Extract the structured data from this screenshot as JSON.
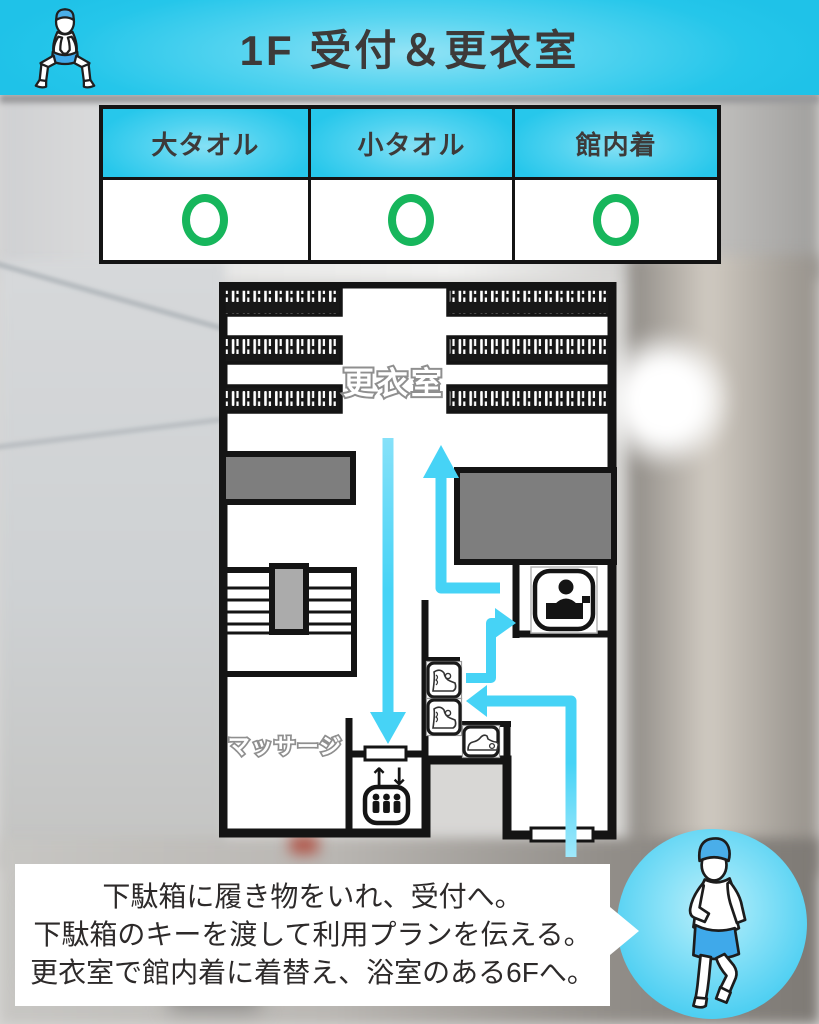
{
  "header": {
    "title": "1F 受付＆更衣室",
    "icon": "sauna-squat-person-icon"
  },
  "amenities": {
    "columns": [
      "大タオル",
      "小タオル",
      "館内着"
    ],
    "values": [
      "○",
      "○",
      "○"
    ]
  },
  "floor_plan": {
    "room_labels": {
      "changing_room": "更衣室",
      "massage": "マッサージ"
    },
    "elevator_arrows": "↑↓",
    "icons": [
      "reception-desk-icon",
      "elevator-icon",
      "boot-locker-icon",
      "boot-locker-icon",
      "sneaker-locker-icon"
    ],
    "flow_arrows": [
      "down-to-elevator",
      "up-to-changing-room",
      "to-reception",
      "entrance-to-shoe-lockers"
    ]
  },
  "instructions": {
    "lines": [
      "下駄箱に履き物をいれ、受付へ。",
      "下駄箱のキーを渡して利用プランを伝える。",
      "更衣室で館内着に着替え、浴室のある6Fへ。"
    ]
  },
  "badge": {
    "icon": "walking-sauna-person-icon"
  },
  "colors": {
    "accent_cyan": "#46d3f6",
    "header_cyan": "#25c6ea",
    "ok_green": "#17b65c",
    "wall_black": "#141414",
    "towel_blue": "#3fa9ea",
    "text_dark": "#3d3a39"
  }
}
